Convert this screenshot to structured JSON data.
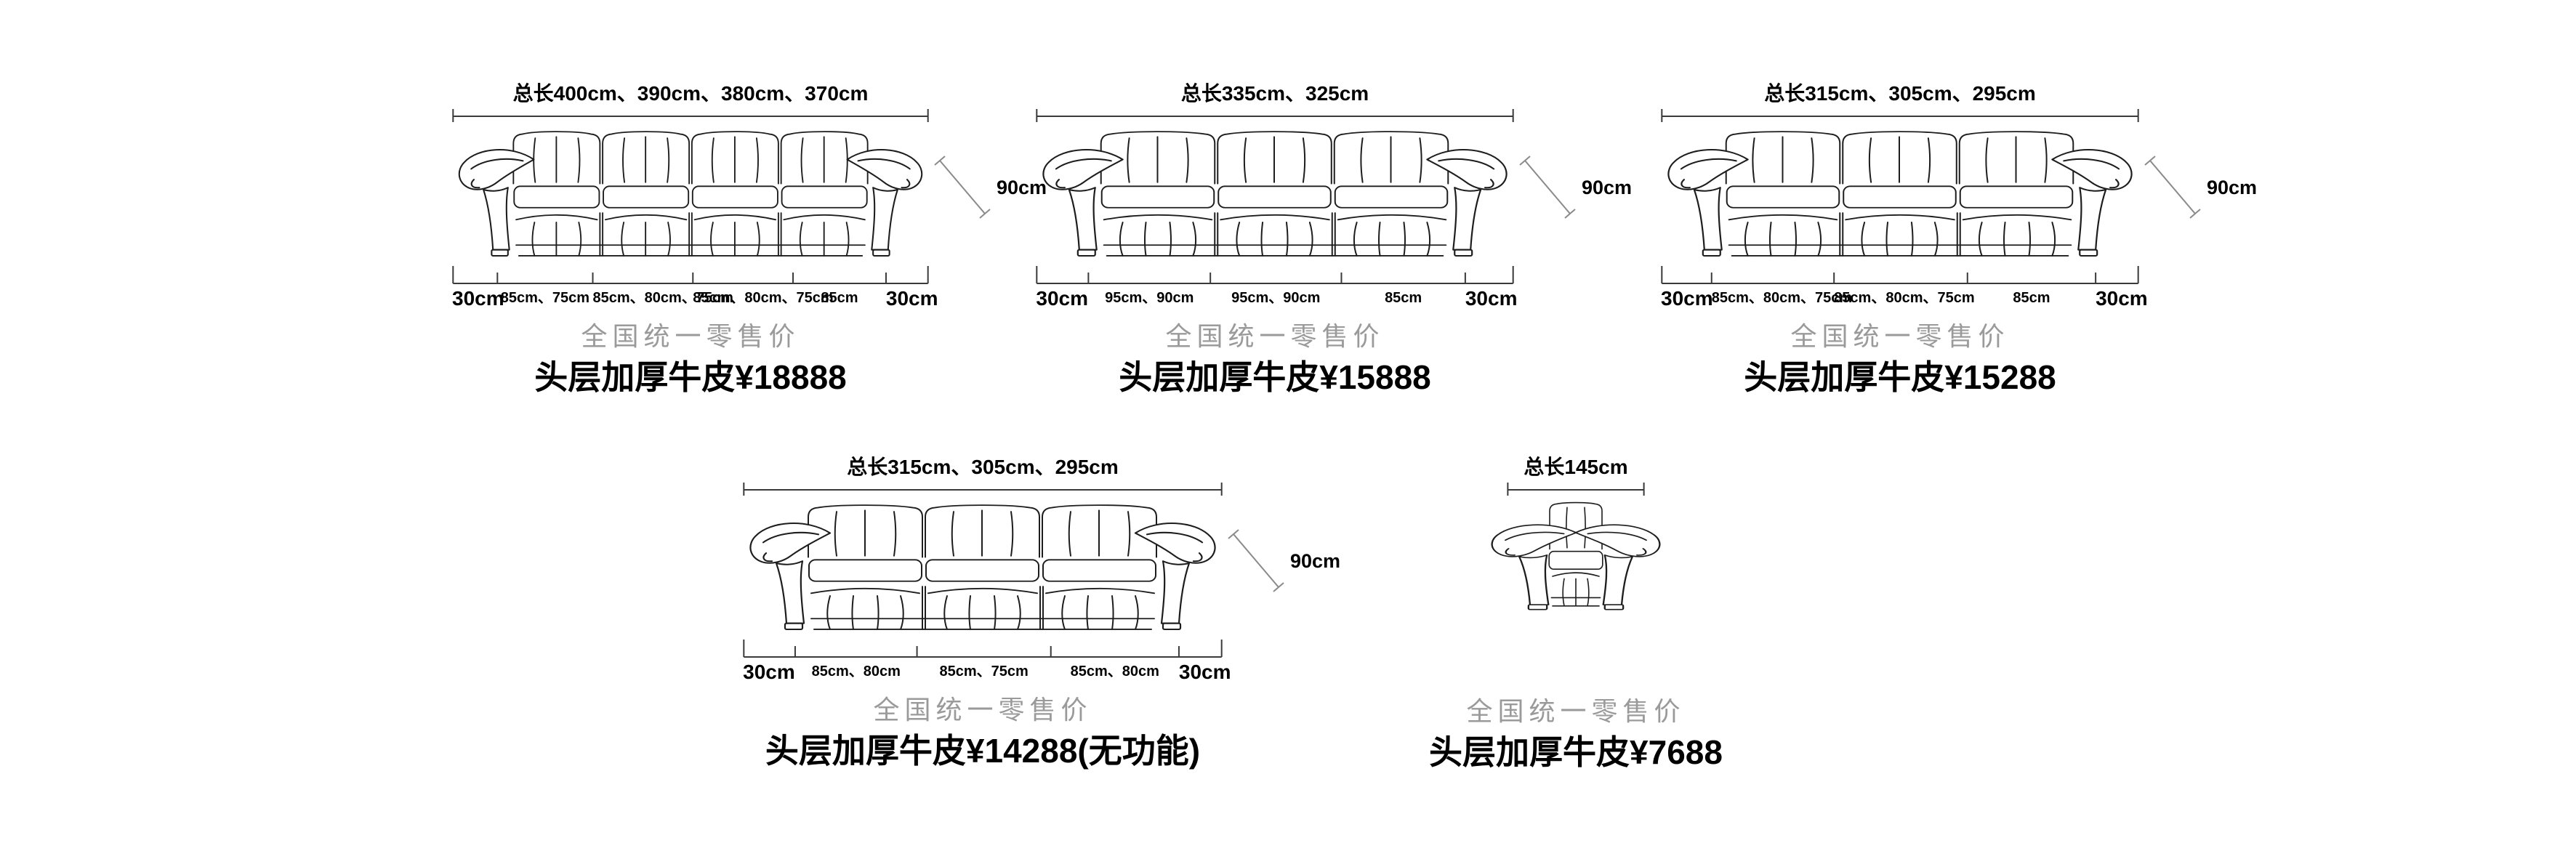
{
  "page": {
    "background": "#ffffff"
  },
  "colors": {
    "line": "#1d1d1d",
    "dimension_line": "#3a3a3a",
    "text": "#000000",
    "muted_caption": "#9a9a9a"
  },
  "products": [
    {
      "name": "four-seat-sofa",
      "total_length_label": "总长400cm、390cm、380cm、370cm",
      "height_label": "90cm",
      "bottom_segments": [
        {
          "label": "30cm",
          "size": 9.5,
          "emph": true
        },
        {
          "label": "85cm、75cm",
          "size": 20
        },
        {
          "label": "85cm、80cm、75cm",
          "size": 21
        },
        {
          "label": "85cm、80cm、75cm",
          "size": 21
        },
        {
          "label": "85cm",
          "size": 19.5
        },
        {
          "label": "30cm",
          "size": 9,
          "emph": true
        }
      ],
      "retail_caption": "全国统一零售价",
      "price_label": "头层加厚牛皮¥18888"
    },
    {
      "name": "three-seat-sofa-335",
      "total_length_label": "总长335cm、325cm",
      "height_label": "90cm",
      "bottom_segments": [
        {
          "label": "30cm",
          "size": 11,
          "emph": true
        },
        {
          "label": "95cm、90cm",
          "size": 25.5
        },
        {
          "label": "95cm、90cm",
          "size": 27.4
        },
        {
          "label": "85cm",
          "size": 25.9
        },
        {
          "label": "30cm",
          "size": 10.2,
          "emph": true
        }
      ],
      "retail_caption": "全国统一零售价",
      "price_label": "头层加厚牛皮¥15888"
    },
    {
      "name": "three-seat-sofa-315",
      "total_length_label": "总长315cm、305cm、295cm",
      "height_label": "90cm",
      "bottom_segments": [
        {
          "label": "30cm",
          "size": 10.6,
          "emph": true
        },
        {
          "label": "85cm、80cm、75cm",
          "size": 25.6
        },
        {
          "label": "85cm、80cm、75cm",
          "size": 27.9
        },
        {
          "label": "85cm",
          "size": 26.8
        },
        {
          "label": "30cm",
          "size": 9.1,
          "emph": true
        }
      ],
      "retail_caption": "全国统一零售价",
      "price_label": "头层加厚牛皮¥15288"
    },
    {
      "name": "three-seat-sofa-315-no-function",
      "total_length_label": "总长315cm、305cm、295cm",
      "height_label": "90cm",
      "bottom_segments": [
        {
          "label": "30cm",
          "size": 10.9,
          "emph": true
        },
        {
          "label": "85cm、80cm",
          "size": 25.4
        },
        {
          "label": "85cm、75cm",
          "size": 27.9
        },
        {
          "label": "85cm、80cm",
          "size": 26.7
        },
        {
          "label": "30cm",
          "size": 9.1,
          "emph": true
        }
      ],
      "retail_caption": "全国统一零售价",
      "price_label": "头层加厚牛皮¥14288(无功能)"
    },
    {
      "name": "single-armchair",
      "total_length_label": "总长145cm",
      "retail_caption": "全国统一零售价",
      "price_label": "头层加厚牛皮¥7688"
    }
  ]
}
